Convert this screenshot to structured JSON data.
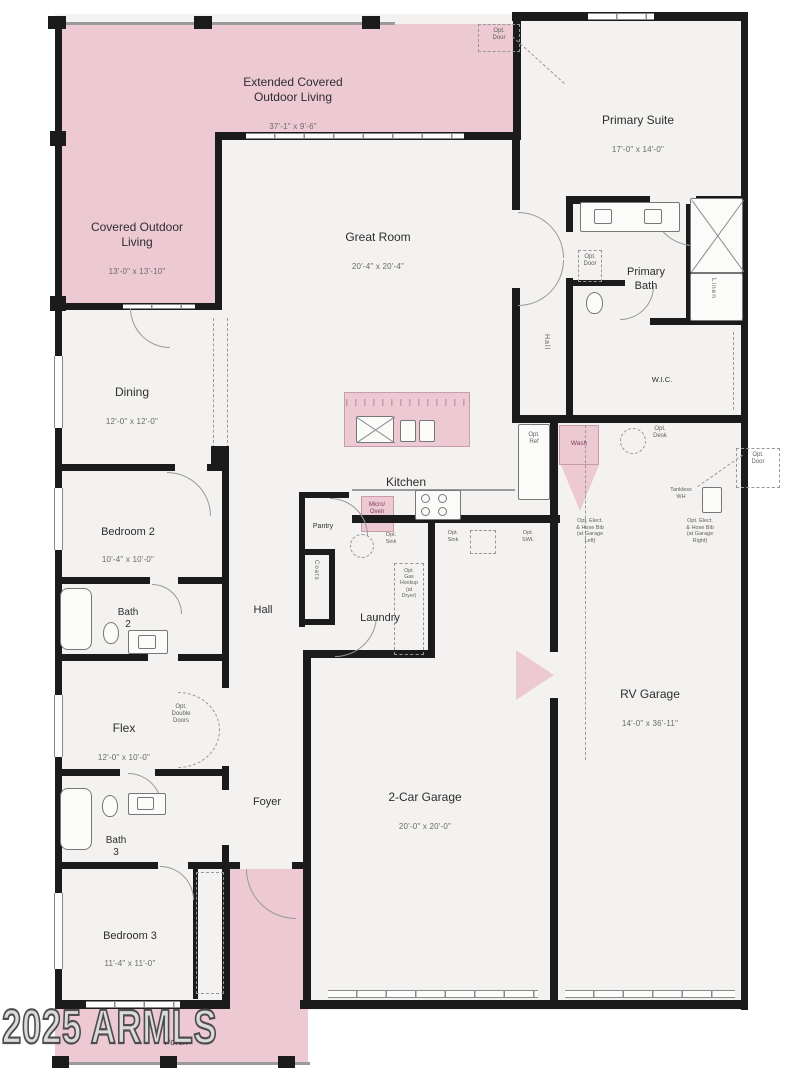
{
  "colors": {
    "pink": "#ecc9d3",
    "wall": "#1b1b1b",
    "floor": "#f3f2f0",
    "line": "#8a8a8a"
  },
  "watermark": "2025 ARMLS",
  "rooms": {
    "extended_outdoor": {
      "name": "Extended Covered\nOutdoor Living",
      "dims": "37'-1\" x 9'-6\""
    },
    "covered_outdoor": {
      "name": "Covered Outdoor\nLiving",
      "dims": "13'-0\" x 13'-10\""
    },
    "primary_suite": {
      "name": "Primary Suite",
      "dims": "17'-0\" x 14'-0\""
    },
    "great_room": {
      "name": "Great Room",
      "dims": "20'-4\" x 20'-4\""
    },
    "primary_bath": {
      "name": "Primary\nBath"
    },
    "wic": {
      "name": "W.I.C."
    },
    "linen": {
      "name": "Linen"
    },
    "hall_suite": {
      "name": "Hall"
    },
    "dining": {
      "name": "Dining",
      "dims": "12'-0\" x 12'-0\""
    },
    "kitchen": {
      "name": "Kitchen"
    },
    "pantry": {
      "name": "Pantry"
    },
    "coats": {
      "name": "Coats"
    },
    "hall": {
      "name": "Hall"
    },
    "laundry": {
      "name": "Laundry"
    },
    "bedroom2": {
      "name": "Bedroom 2",
      "dims": "10'-4\" x 10'-0\""
    },
    "bath2": {
      "name": "Bath\n2"
    },
    "flex": {
      "name": "Flex",
      "dims": "12'-0\" x 10'-0\""
    },
    "bath3": {
      "name": "Bath\n3"
    },
    "bedroom3": {
      "name": "Bedroom 3",
      "dims": "11'-4\" x 11'-0\""
    },
    "foyer": {
      "name": "Foyer"
    },
    "garage": {
      "name": "2-Car Garage",
      "dims": "20'-0\" x 20'-0\""
    },
    "rv_garage": {
      "name": "RV Garage",
      "dims": "14'-0\" x 36'-11\""
    },
    "porch": {
      "name": "Porch"
    }
  },
  "annotations": {
    "opt_door_top": "Opt.\nDoor",
    "opt_door_bath": "Opt.\nDoor",
    "opt_door_rv": "Opt.\nDoor",
    "micro_oven": "Micro/\nOven",
    "opt_ref": "Opt.\nRef",
    "wash": "Wash",
    "opt_desk": "Opt.\nDesk",
    "tankless_wh": "Tankless\nWH",
    "hose_bib_right": "Opt. Elect.\n& Hose Bib\n(at Garage\nRight)",
    "hose_bib_left": "Opt. Elect.\n& Hose Bib\n(at Garage\nLeft)",
    "opt_sink_kitchen": "Opt.\nSink",
    "opt_sink_garage": "Opt.\nSink",
    "opt_swl": "Opt.\nSWL",
    "opt_gas_dryer": "Opt.\nGas\nHookup\n(at\nDryer)",
    "opt_double_doors": "Opt.\nDouble\nDoors"
  }
}
